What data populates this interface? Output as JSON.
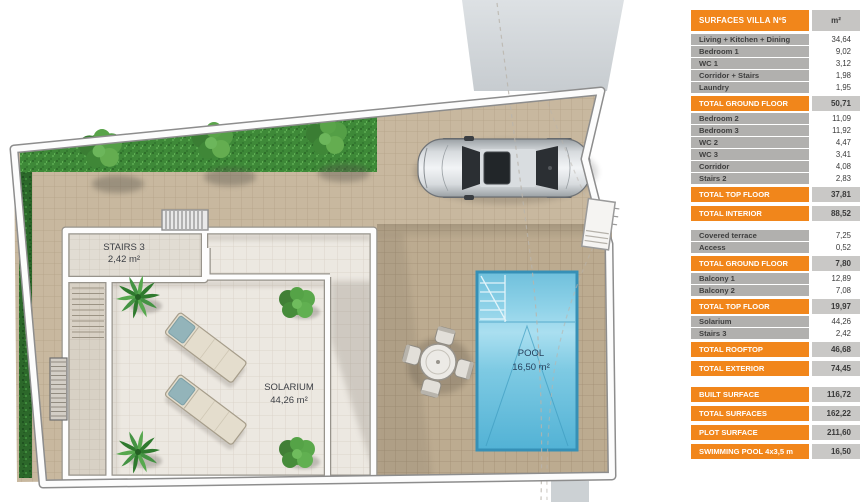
{
  "plan": {
    "labels": {
      "stairs3_name": "STAIRS 3",
      "stairs3_area": "2,42 m²",
      "solarium_name": "SOLARIUM",
      "solarium_area": "44,26 m²",
      "pool_name": "POOL",
      "pool_area": "16,50 m²"
    },
    "colors": {
      "paving_tan": "#C8B89F",
      "deck_tan": "#BCAB90",
      "solarium_floor": "#ECE8E1",
      "grass_green": "#3E8938",
      "hedge_green": "#2C682A",
      "pool_blue": "#7EC9E3",
      "wall_white": "#FDFDFD"
    }
  },
  "table": {
    "header": {
      "label": "SURFACES VILLA Nº5",
      "unit": "m²"
    },
    "accent": "#F1861B",
    "rows": [
      {
        "t": "head",
        "label": "SURFACES VILLA Nº5",
        "value": "m²"
      },
      {
        "t": "r",
        "label": "Living + Kitchen + Dining",
        "value": "34,64"
      },
      {
        "t": "r",
        "label": "Bedroom 1",
        "value": "9,02"
      },
      {
        "t": "r",
        "label": "WC 1",
        "value": "3,12"
      },
      {
        "t": "r",
        "label": "Corridor + Stairs",
        "value": "1,98"
      },
      {
        "t": "r",
        "label": "Laundry",
        "value": "1,95"
      },
      {
        "t": "tot",
        "label": "TOTAL GROUND FLOOR",
        "value": "50,71"
      },
      {
        "t": "r",
        "label": "Bedroom 2",
        "value": "11,09"
      },
      {
        "t": "r",
        "label": "Bedroom 3",
        "value": "11,92"
      },
      {
        "t": "r",
        "label": "WC 2",
        "value": "4,47"
      },
      {
        "t": "r",
        "label": "WC 3",
        "value": "3,41"
      },
      {
        "t": "r",
        "label": "Corridor",
        "value": "4,08"
      },
      {
        "t": "r",
        "label": "Stairs 2",
        "value": "2,83"
      },
      {
        "t": "tot",
        "label": "TOTAL TOP FLOOR",
        "value": "37,81"
      },
      {
        "t": "tot",
        "label": "TOTAL INTERIOR",
        "value": "88,52"
      },
      {
        "t": "gap"
      },
      {
        "t": "r",
        "label": "Covered terrace",
        "value": "7,25"
      },
      {
        "t": "r",
        "label": "Access",
        "value": "0,52"
      },
      {
        "t": "tot",
        "label": "TOTAL GROUND FLOOR",
        "value": "7,80"
      },
      {
        "t": "r",
        "label": "Balcony 1",
        "value": "12,89"
      },
      {
        "t": "r",
        "label": "Balcony 2",
        "value": "7,08"
      },
      {
        "t": "tot",
        "label": "TOTAL TOP FLOOR",
        "value": "19,97"
      },
      {
        "t": "r",
        "label": "Solarium",
        "value": "44,26"
      },
      {
        "t": "r",
        "label": "Stairs 3",
        "value": "2,42"
      },
      {
        "t": "tot",
        "label": "TOTAL ROOFTOP",
        "value": "46,68"
      },
      {
        "t": "tot",
        "label": "TOTAL EXTERIOR",
        "value": "74,45"
      },
      {
        "t": "gap"
      },
      {
        "t": "tot",
        "label": "BUILT SURFACE",
        "value": "116,72"
      },
      {
        "t": "tot",
        "label": "TOTAL SURFACES",
        "value": "162,22"
      },
      {
        "t": "tot",
        "label": "PLOT SURFACE",
        "value": "211,60"
      },
      {
        "t": "tot",
        "label": "SWIMMING POOL 4x3,5 m",
        "value": "16,50"
      }
    ]
  }
}
